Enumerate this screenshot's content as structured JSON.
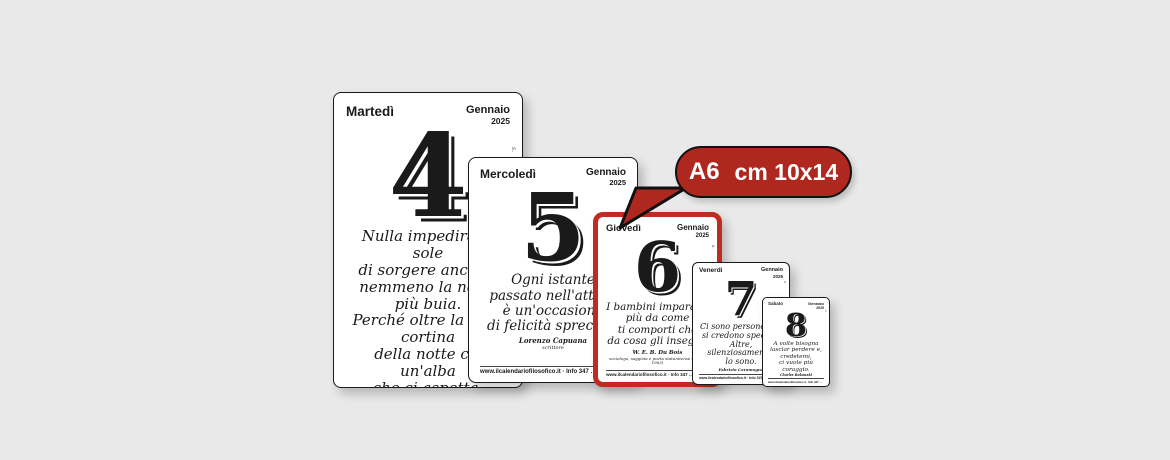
{
  "colors": {
    "background": "#e9e9e9",
    "card_border": "#1a1a1a",
    "highlight_red": "#bf2b20",
    "bubble_red": "#ae2820",
    "bubble_outline": "#111111",
    "bubble_text": "#ffffff"
  },
  "callout": {
    "size_label": "A6",
    "dimensions_label": "cm 10x14"
  },
  "cards": [
    {
      "day_name": "Martedì",
      "month": "Gennaio",
      "year": "2025",
      "day_number": "4",
      "quote_lines": [
        "Nulla impedirà al sole",
        "di sorgere ancora,",
        "nemmeno la notte più buia.",
        "Perché oltre la nera cortina",
        "della notte c'è un'alba",
        "che ci aspetta."
      ],
      "author": "Kahlil Gibran",
      "author_role": "poeta, pittore e filosofo libanese",
      "saint_note": "s.",
      "footer": "www.ilcalendariofilosofico.it  ·  Info 347 …"
    },
    {
      "day_name": "Mercoledì",
      "month": "Gennaio",
      "year": "2025",
      "day_number": "5",
      "quote_lines": [
        "Ogni istante",
        "passato nell'attesa",
        "è un'occasione",
        "di felicità sprecata."
      ],
      "author": "Lorenzo Capuana",
      "author_role": "scrittore",
      "saint_note": "s.",
      "footer": "www.ilcalendariofilosofico.it  ·  Info 347 …"
    },
    {
      "day_name": "Giovedì",
      "month": "Gennaio",
      "year": "2025",
      "day_number": "6",
      "quote_lines": [
        "I bambini imparano",
        "più da come",
        "ti comporti che",
        "da cosa gli insegni."
      ],
      "author": "W. E. B. Du Bois",
      "author_role": "sociologo, saggista e poeta statunitense (1868 - 1963)",
      "saint_note": "s.",
      "footer": "www.ilcalendariofilosofico.it  ·  Info 347 …"
    },
    {
      "day_name": "Venerdì",
      "month": "Gennaio",
      "year": "2025",
      "day_number": "7",
      "quote_lines": [
        "Ci sono persone che",
        "si credono speciali.",
        "Altre,",
        "silenziosamente,",
        "lo sono."
      ],
      "author": "Fabrizio Caramagna",
      "author_role": "",
      "saint_note": "s.",
      "footer": "www.ilcalendariofilosofico.it  ·  Info 347 …"
    },
    {
      "day_name": "Sabato",
      "month": "Gennaio",
      "year": "2025",
      "day_number": "8",
      "quote_lines": [
        "A volte bisogna",
        "lasciar perdere e,",
        "credetemi,",
        "ci vuole più",
        "coraggio."
      ],
      "author": "Charles Bukowski",
      "author_role": "",
      "saint_note": "s.",
      "footer": "www.ilcalendariofilosofico.it  ·  Info 347 …"
    }
  ]
}
